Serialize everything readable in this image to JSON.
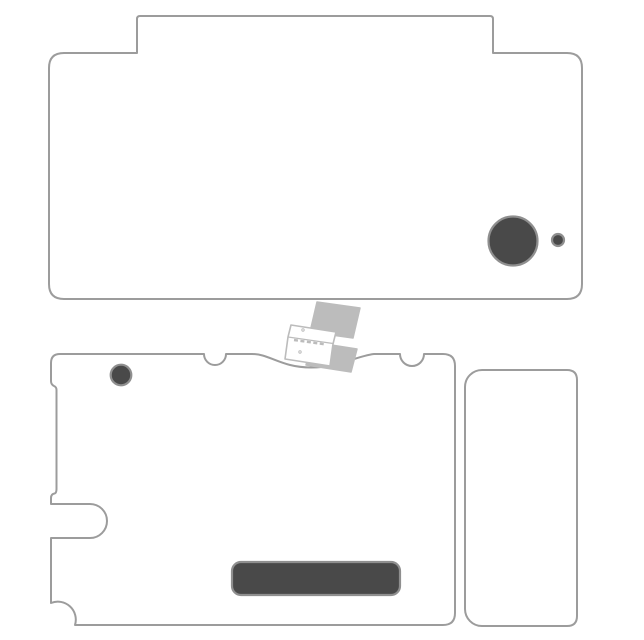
{
  "canvas": {
    "width": 644,
    "height": 640,
    "background_color": "#ffffff"
  },
  "colors": {
    "background": "#ffffff",
    "shape_fill": "#ffffff",
    "outline": "#9c9c9c",
    "cutout_fill": "#494949",
    "cutout_ring": "#8f8f8f",
    "watermark_gray": "#bcbcbc"
  },
  "pieces": [
    {
      "id": "top-shell-skin",
      "description": "upper skin panel with raised hinge tab and rounded corners",
      "cutouts": [
        "camera-lens-cutout",
        "microphone-cutout"
      ]
    },
    {
      "id": "bottom-shell-skin",
      "description": "lower skin panel with wavy hinge edge, two半circular notches, side stylus slot and corner scoop",
      "cutouts": [
        "inner-camera-cutout",
        "label-window-cutout",
        "stylus-slot-cutout",
        "corner-scoop-cutout"
      ]
    },
    {
      "id": "side-strip-skin",
      "description": "narrow vertical side panel with notched left corners"
    }
  ],
  "watermark": {
    "id": "device-illustration",
    "description": "light gray isometric drawing of an open handheld console"
  }
}
